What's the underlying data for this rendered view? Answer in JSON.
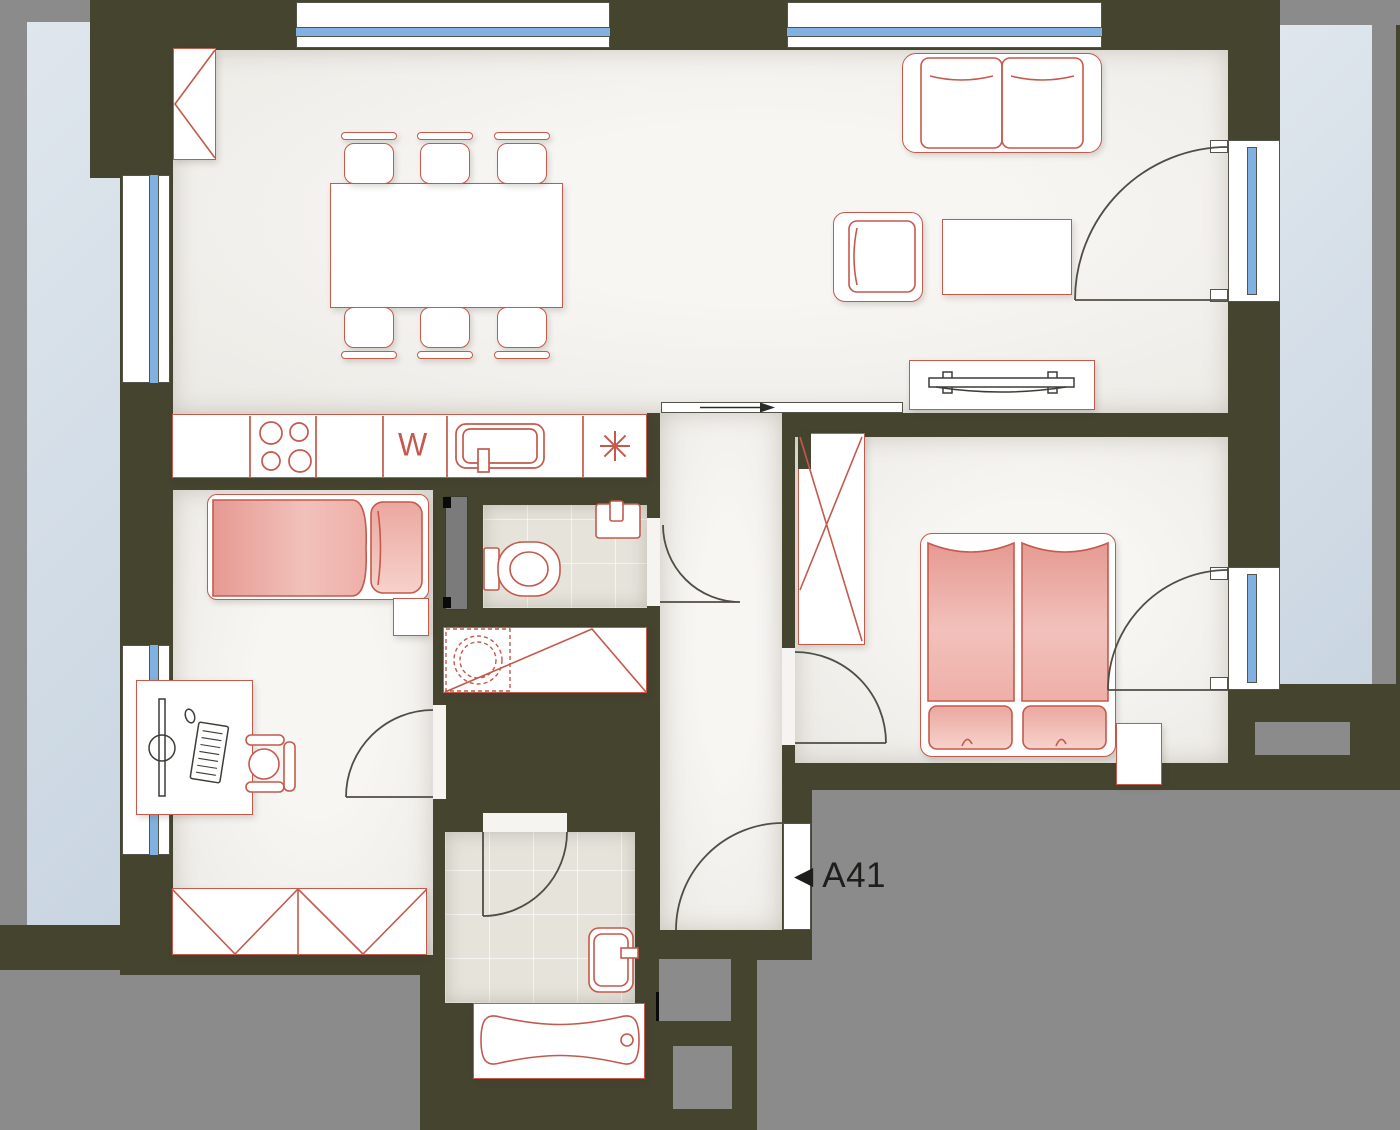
{
  "unit": {
    "entrance_label": "A41",
    "entrance_arrow": "◀"
  },
  "kitchen": {
    "dishwasher_symbol": "W",
    "refrigerator_icon": "snowflake-asterisk"
  },
  "colors": {
    "wall": "#45442f",
    "exterior_gray": "#8b8b8b",
    "floor": "#f1efeb",
    "tile_floor": "#e6e3db",
    "balcony_glass": "#d7e0e9",
    "window_glass": "#80b1e0",
    "furniture_outline": "#c4594c",
    "bed_fill": "#efb0a9",
    "label_text": "#1d1d1b"
  }
}
